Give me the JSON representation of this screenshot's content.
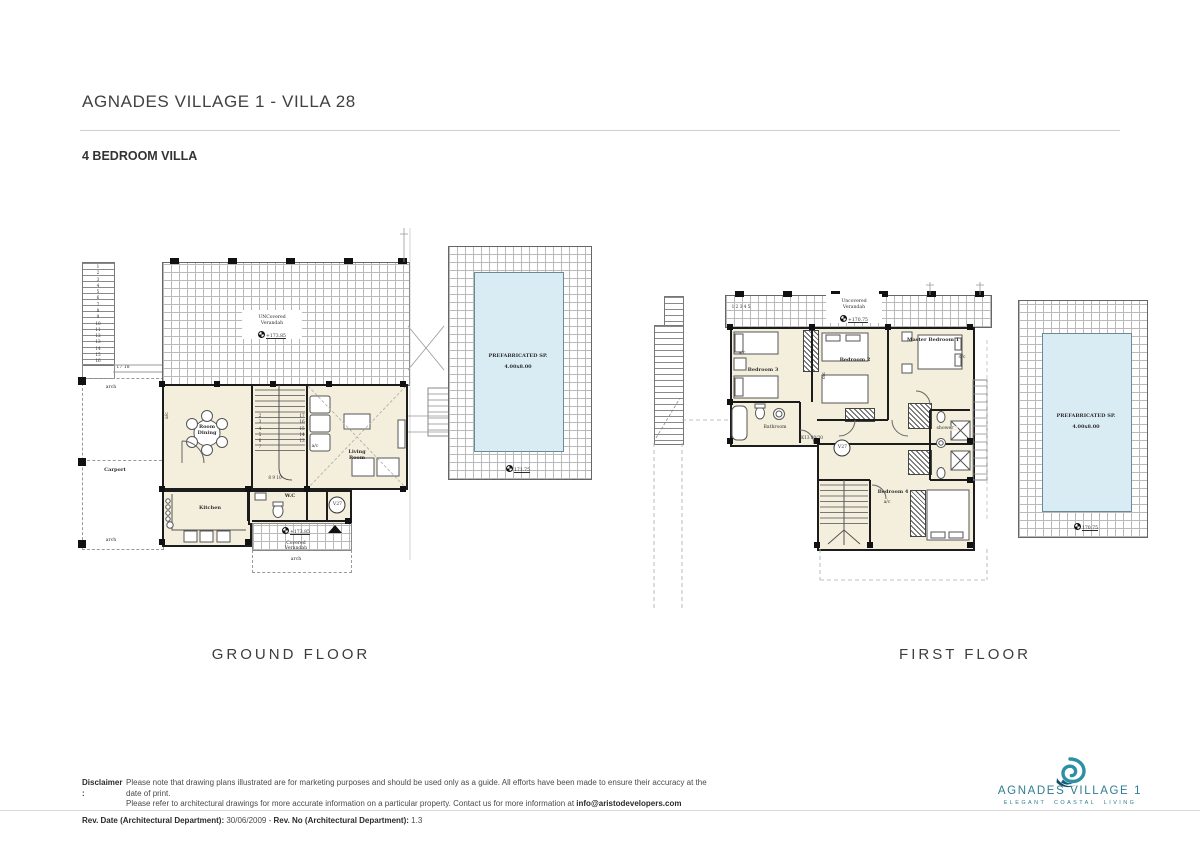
{
  "header": {
    "title": "AGNADES VILLAGE 1 - VILLA 28",
    "subtitle": "4 BEDROOM VILLA"
  },
  "plans": {
    "ground": {
      "caption": "GROUND FLOOR",
      "verandah_top": "UNCovered\nVerandah",
      "verandah_top_level": "+173.85",
      "verandah_bottom_level": "+173.85",
      "verandah_bottom": "Covered\nVerandah",
      "verandah_bottom_arch": "arch",
      "dining": "Room\nDining",
      "kitchen": "Kitchen",
      "wc": "W.C",
      "living": "Living\nRoom",
      "carport": "Carport",
      "arch_top": "arch",
      "arch_bottom": "arch",
      "ac_dining": "a/c",
      "ac_living": "a/c",
      "v27": "V27",
      "stair_numbers": "1\n2\n3\n4\n5\n6\n7\n8\n9\n10\n11\n12\n13\n14\n15\n16",
      "stair_turn": "17 18",
      "inner_left": "2\n3\n4\n5\n6\n7",
      "inner_right": "17\n16\n15\n14\n13",
      "inner_bottom": "8  9  10",
      "pool": {
        "name": "PREFABRICATED  SP.",
        "size": "4.00x8.00",
        "level": "171.75"
      }
    },
    "first": {
      "caption": "FIRST FLOOR",
      "verandah": "Uncovered\nVerandah",
      "verandah_level": "+170.75",
      "steps": "1 2 3 4 5",
      "bedroom3": "Bedroom 3",
      "bedroom2": "Bedroom 2",
      "master": "Master Bedroom 1",
      "bedroom4": "Bedroom 4",
      "bathroom": "Bathroom",
      "shower": "shower",
      "k13": "K13 80/20",
      "v27": "V27",
      "ac3": "a/c",
      "ac4": "a/c",
      "oc2": "o/c",
      "oc_master": "o/c",
      "pool": {
        "name": "PREFABRICATED  SP.",
        "size": "4.00x8.00",
        "level": "170.75"
      }
    }
  },
  "footer": {
    "disclaimer_label": "Disclaimer :",
    "disclaimer_line1": "Please note that drawing plans illustrated are for marketing purposes and should be used only as a guide. All efforts have been made to ensure their accuracy at the date of print.",
    "disclaimer_line2": "Please refer to architectural drawings for more accurate information on a particular property. Contact us for more information at ",
    "disclaimer_email": "info@aristodevelopers.com",
    "rev_label1": "Rev. Date (Architectural Department):",
    "rev_value1": " 30/06/2009 - ",
    "rev_label2": "Rev. No (Architectural Department):",
    "rev_value2": " 1.3"
  },
  "logo": {
    "name": "AGNADES VILLAGE 1",
    "tagline": "ELEGANT COASTAL LIVING"
  },
  "colors": {
    "cream": "#f4eedd",
    "pool_blue": "#d9ecf3",
    "teal": "#2d8fa3",
    "navy": "#0e4e68",
    "wall": "#1c1c1c"
  }
}
